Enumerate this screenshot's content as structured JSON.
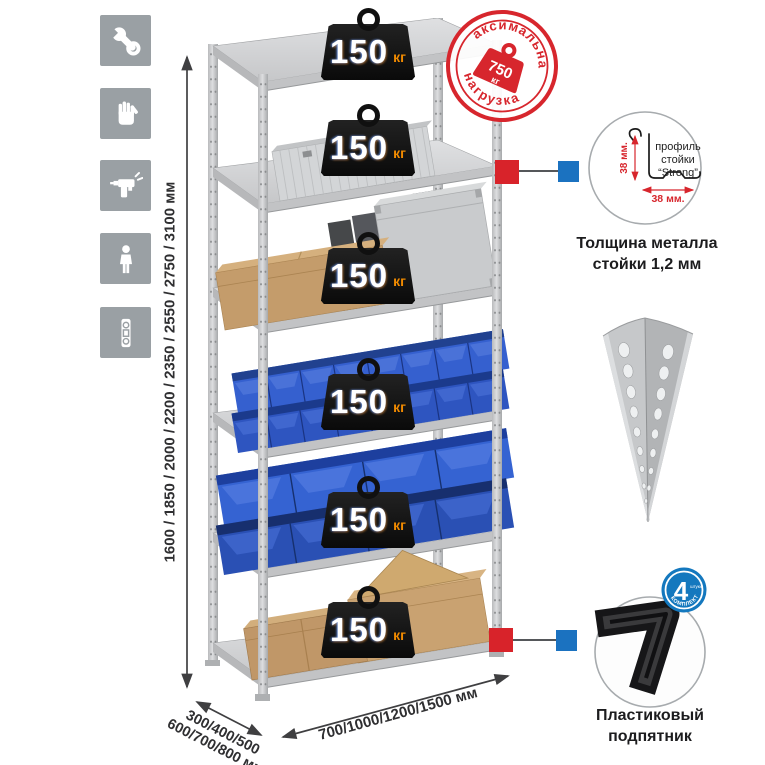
{
  "page_background": "#ffffff",
  "assembly_icons": [
    {
      "name": "wrench"
    },
    {
      "name": "gloves"
    },
    {
      "name": "drill"
    },
    {
      "name": "person"
    },
    {
      "name": "spirit-level"
    }
  ],
  "dimensions": {
    "height": "1600 / 1850 / 2000 / 2200 / 2350 / 2550 / 2750 / 3100 мм",
    "depth_line1": "300/400/500",
    "depth_line2": "600/700/800 мм",
    "width": "700/1000/1200/1500 мм"
  },
  "shelf_badges": [
    {
      "value": "150",
      "unit": "кг"
    },
    {
      "value": "150",
      "unit": "кг"
    },
    {
      "value": "150",
      "unit": "кг"
    },
    {
      "value": "150",
      "unit": "кг"
    },
    {
      "value": "150",
      "unit": "кг"
    },
    {
      "value": "150",
      "unit": "кг"
    }
  ],
  "stamp": {
    "arc_top": "максимальная",
    "arc_bottom": "нагрузка",
    "value": "750",
    "unit": "кг"
  },
  "profile": {
    "line1": "профиль",
    "line2": "стойки",
    "line3": "“Strong”",
    "dim_vertical": "38 мм.",
    "dim_horizontal": "38 мм.",
    "caption1": "Толщина металла",
    "caption2": "стойки 1,2 мм"
  },
  "foot": {
    "badge_number": "4",
    "badge_word": "штуки",
    "badge_arc": "в комплекте",
    "caption1": "Пластиковый",
    "caption2": "подпятник"
  },
  "colors": {
    "stamp_red": "#d7262d",
    "connector_red": "#d8232a",
    "connector_blue": "#1b72c0",
    "bin_blue": "#2e55c0",
    "icon_gray": "#9aa0a4",
    "badge_orange": "#f08a00"
  }
}
